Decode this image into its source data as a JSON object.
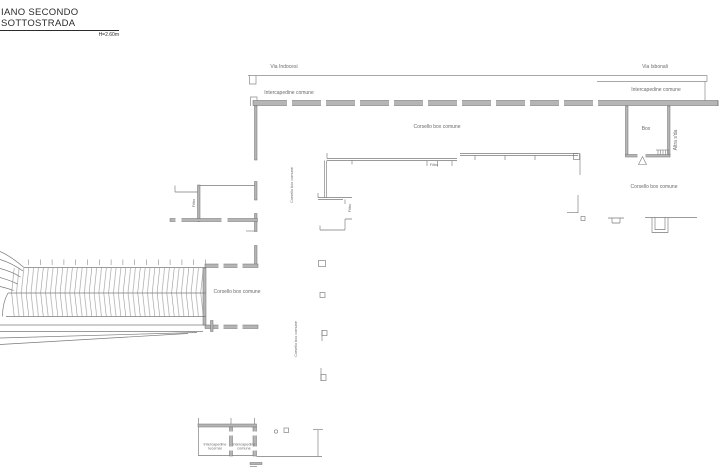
{
  "drawing": {
    "title": "IANO SECONDO SOTTOSTRADA",
    "height_note": "H=2.60m"
  },
  "labels": {
    "via_left": "Via Indocesi",
    "via_right": "Via Isbonali",
    "intercapedine_top_left": "Intercapedine comune",
    "intercapedine_top_right": "Intercapedine comune",
    "corsello_top": "Corsello box comune",
    "box": "Box",
    "altra_strada": "Altra s'da",
    "corsello_right": "Corsello box comune",
    "corsello_vertical_upper": "Corsello box comune",
    "filtro_left": "Filtro",
    "filtro_mid": "Filtro",
    "filtro_mid_vertical": "Filtro",
    "corsello_left": "Corsello box comune",
    "corsello_vertical_lower": "Corsello box comune",
    "intercapedine_lucernai": "Intercapedine lucernai",
    "intercapedine_bottom": "Intercapedine comune"
  },
  "colors": {
    "background": "#ffffff",
    "line": "#7a7a7a",
    "wall_fill": "#b5b5b5",
    "title_text": "#2b2b2b"
  }
}
